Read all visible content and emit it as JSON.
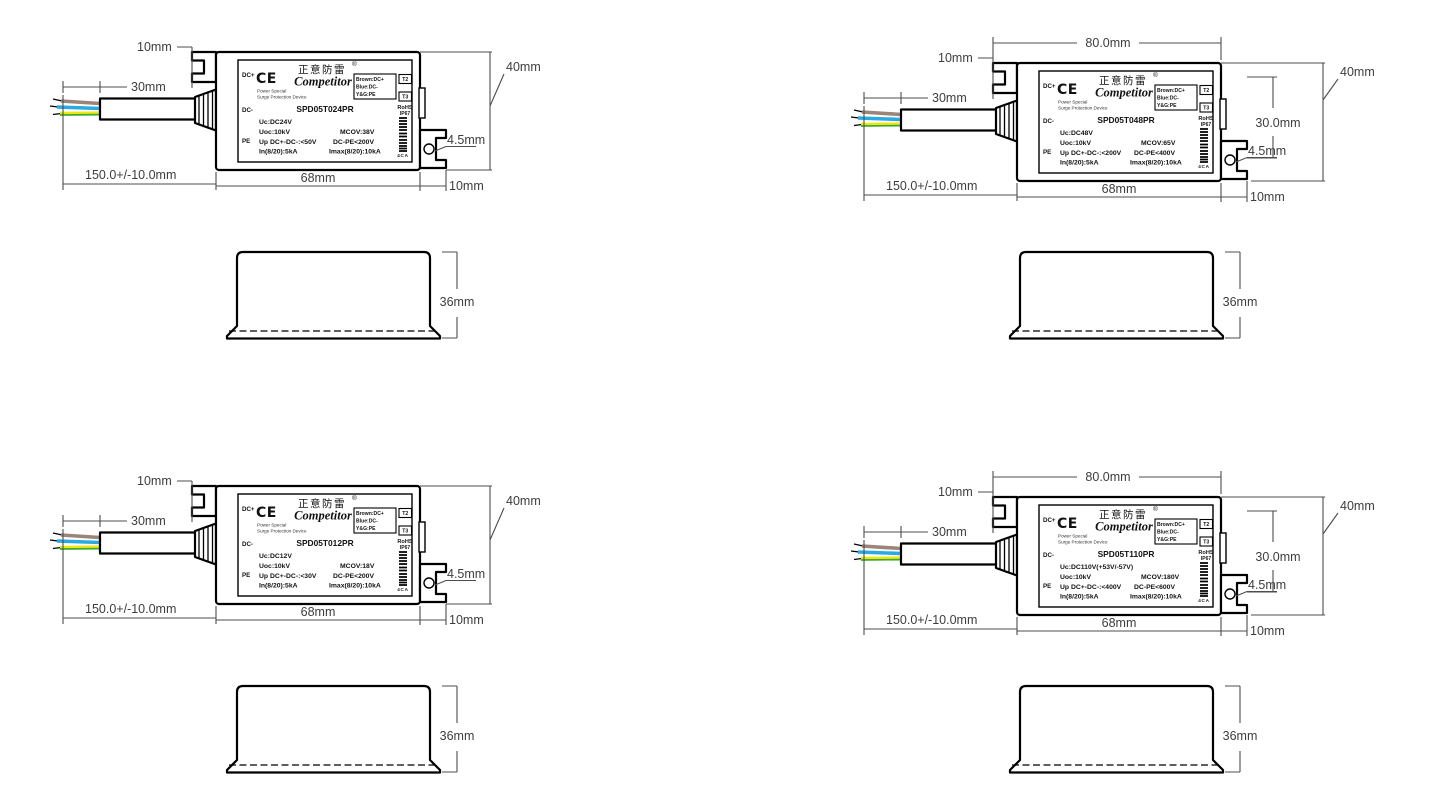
{
  "shared": {
    "ce_mark": "CE",
    "brand_cn": "正意防雷",
    "registered_mark": "®",
    "brand": "Competitor",
    "tagline_line1": "Power Special",
    "tagline_line2": "Surge Protection Device",
    "terminal_dc_plus": "DC+",
    "terminal_dc_minus": "DC-",
    "terminal_pe": "PE",
    "wire_legend": {
      "line1": "Brown:DC+",
      "line2": "Blue:DC-",
      "line3": "Y&G:PE"
    },
    "type_class_t2": "T2",
    "type_class_t3": "T3",
    "rohs": "RoHS",
    "ip_rating": "IP67",
    "barcode_caption": "4CA",
    "dims": {
      "tab_width": "10mm",
      "strip_length": "30mm",
      "cable_length": "150.0+/-10.0mm",
      "body_width": "68mm",
      "right_tab": "10mm",
      "overall_height": "40mm",
      "hole_diameter": "4.5mm",
      "side_height": "36mm",
      "top_width": "80.0mm",
      "hole_pitch": "30.0mm"
    },
    "colors": {
      "wire_brown": "#9b8579",
      "wire_blue": "#29abe2",
      "wire_yellow": "#f2e611",
      "wire_green": "#3aaa35",
      "line_black": "#000000",
      "dim_gray": "#3d3d3d"
    }
  },
  "units": [
    {
      "variant": "left",
      "model": "SPD05T024PR",
      "uc": "Uc:DC24V",
      "uoc": "Uoc:10kV",
      "mcov": "MCOV:38V",
      "up": "Up DC+-DC-:<50V",
      "dc_pe": "DC-PE<200V",
      "in_rating": "In(8/20):5kA",
      "imax": "Imax(8/20):10kA"
    },
    {
      "variant": "right",
      "model": "SPD05T048PR",
      "uc": "Uc:DC48V",
      "uoc": "Uoc:10kV",
      "mcov": "MCOV:65V",
      "up": "Up DC+-DC-:<200V",
      "dc_pe": "DC-PE<400V",
      "in_rating": "In(8/20):5kA",
      "imax": "Imax(8/20):10kA"
    },
    {
      "variant": "left",
      "model": "SPD05T012PR",
      "uc": "Uc:DC12V",
      "uoc": "Uoc:10kV",
      "mcov": "MCOV:18V",
      "up": "Up DC+-DC-:<30V",
      "dc_pe": "DC-PE<200V",
      "in_rating": "In(8/20):5kA",
      "imax": "Imax(8/20):10kA"
    },
    {
      "variant": "right",
      "model": "SPD05T110PR",
      "uc": "Uc:DC110V(+53V/-57V)",
      "uoc": "Uoc:10kV",
      "mcov": "MCOV:180V",
      "up": "Up DC+-DC-:<400V",
      "dc_pe": "DC-PE<600V",
      "in_rating": "In(8/20):5kA",
      "imax": "Imax(8/20):10kA"
    }
  ]
}
